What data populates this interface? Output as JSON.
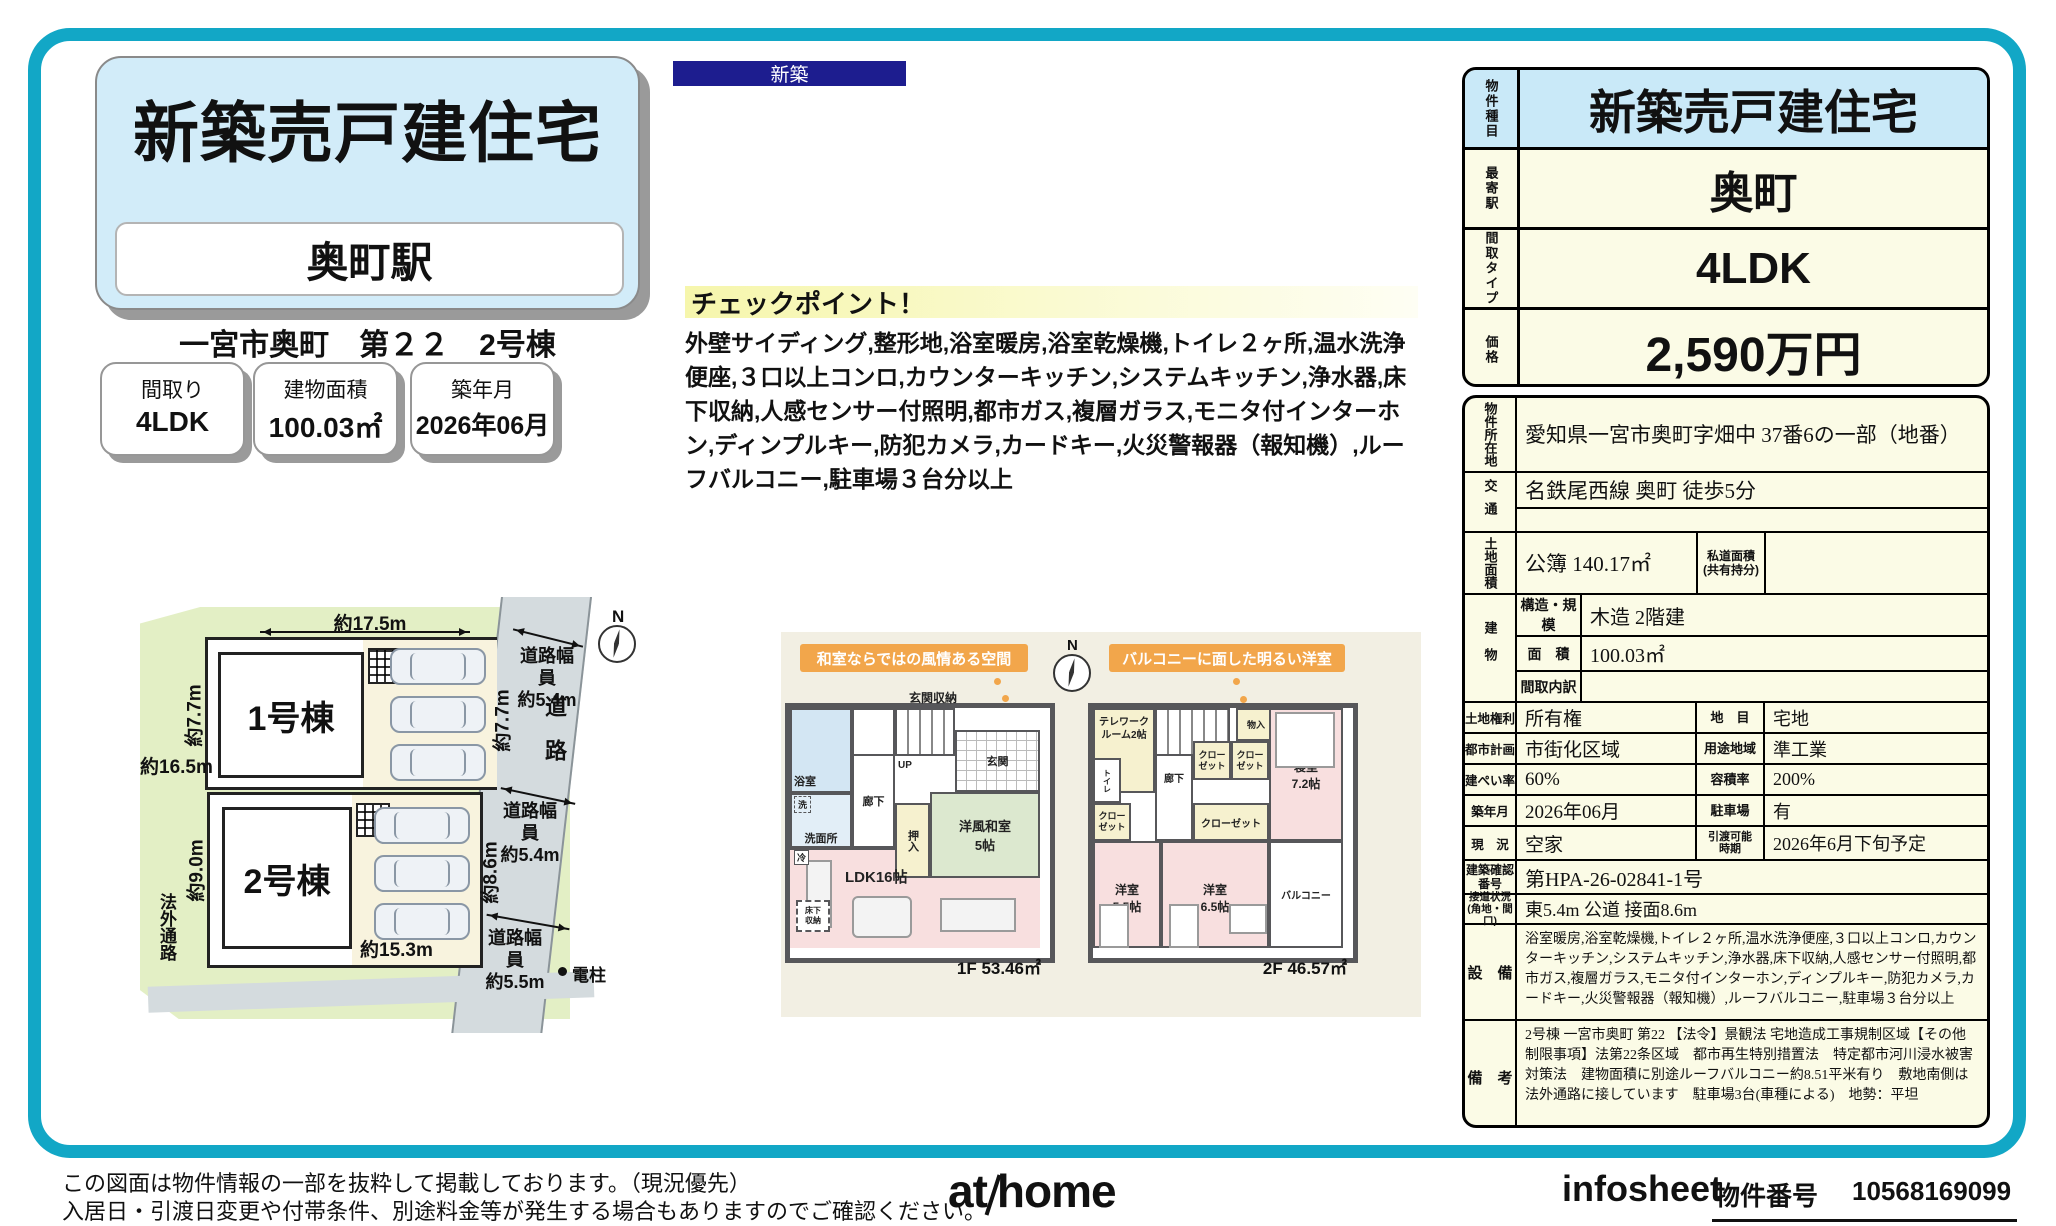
{
  "badge": {
    "label": "新築"
  },
  "header": {
    "title": "新築売戸建住宅",
    "station": "奥町駅",
    "subtitle": "一宮市奥町　第２２　2号棟"
  },
  "specs": [
    {
      "label": "間取り",
      "value": "4LDK"
    },
    {
      "label": "建物面積",
      "value": "100.03㎡"
    },
    {
      "label": "築年月",
      "value": "2026年06月"
    }
  ],
  "checkpoint": {
    "title": "チェックポイント！",
    "body": "外壁サイディング,整形地,浴室暖房,浴室乾燥機,トイレ２ヶ所,温水洗浄便座,３口以上コンロ,カウンターキッチン,システムキッチン,浄水器,床下収納,人感センサー付照明,都市ガス,複層ガラス,モニタ付インターホン,ディンプルキー,防犯カメラ,カードキー,火災警報器（報知機）,ルーフバルコニー,駐車場３台分以上"
  },
  "siteplan": {
    "north": "N",
    "lot1": "1号棟",
    "lot2": "2号棟",
    "dim_top": "約17.5m",
    "dim_left_upper": "約7.7m",
    "dim_left_mid": "約16.5m",
    "dim_left_lower": "約9.0m",
    "dim_bottom": "約15.3m",
    "dim_right_upper": "約7.7m",
    "dim_right_lower": "約8.6m",
    "road": "道路",
    "road_width_top": "道路幅員\n約5.4m",
    "road_width_mid": "道路幅員\n約5.4m",
    "road_width_bottom": "道路幅員\n約5.5m",
    "pole": "電柱",
    "outside_path": "法外通路"
  },
  "floorplan": {
    "callout1": "和室ならではの風情ある空間",
    "callout2": "バルコニーに面した明るい洋室",
    "north": "N",
    "f1": {
      "bath": "浴室",
      "laundry": "洗",
      "wash": "洗面所",
      "entrance_storage": "玄関収納",
      "up": "UP",
      "hall": "廊下",
      "entrance": "玄関",
      "oshiire": "押入",
      "tatami": "洋風和室\n5帖",
      "ldk": "LDK16帖",
      "underfloor": "床下\n収納",
      "fridge": "冷",
      "area": "1F 53.46㎡"
    },
    "f2": {
      "telework": "テレワーク\nルーム2帖",
      "dn": "DN",
      "mono": "物入",
      "closet_a": "クロー\nゼット",
      "closet_b": "クロー\nゼット",
      "hall": "廊下",
      "toilet": "トイレ",
      "bedroom": "寝室\n7.2帖",
      "closet_c": "クロー\nゼット",
      "closet_d": "クローゼット",
      "western_a": "洋室\n5.5帖",
      "western_b": "洋室\n6.5帖",
      "balcony": "バルコニー",
      "area": "2F 46.57㎡"
    }
  },
  "summary": {
    "rows": [
      {
        "label": "物件種目",
        "value": "新築売戸建住宅"
      },
      {
        "label": "最寄駅",
        "value": "奥町"
      },
      {
        "label": "間取タイプ",
        "value": "4LDK"
      },
      {
        "label": "価格",
        "value": "2,590万円"
      }
    ]
  },
  "details": {
    "location": {
      "label": "物件所在地",
      "value": "愛知県一宮市奥町字畑中 37番6の一部（地番）"
    },
    "access": {
      "label": "交通",
      "value": "名鉄尾西線 奥町 徒歩5分"
    },
    "land": {
      "label": "土地面積",
      "value": "公簿 140.17㎡",
      "sub_label": "私道面積\n(共有持分)",
      "sub_value": ""
    },
    "building": {
      "label": "建物",
      "rows": [
        {
          "label": "構造・規模",
          "value": "木造 2階建"
        },
        {
          "label": "面　積",
          "value": "100.03㎡"
        },
        {
          "label": "間取内訳",
          "value": ""
        }
      ]
    },
    "pairs": [
      {
        "l1": "土地権利",
        "v1": "所有権",
        "l2": "地　目",
        "v2": "宅地"
      },
      {
        "l1": "都市計画",
        "v1": "市街化区域",
        "l2": "用途地域",
        "v2": "準工業"
      },
      {
        "l1": "建ぺい率",
        "v1": "60%",
        "l2": "容積率",
        "v2": "200%"
      },
      {
        "l1": "築年月",
        "v1": "2026年06月",
        "l2": "駐車場",
        "v2": "有"
      },
      {
        "l1": "現　況",
        "v1": "空家",
        "l2": "引渡可能\n時期",
        "v2": "2026年6月下旬予定"
      }
    ],
    "confirm": {
      "label": "建築確認\n番号",
      "value": "第HPA-26-02841-1号"
    },
    "road": {
      "label": "接道状況\n(角地・間口)",
      "value": "東5.4m 公道 接面8.6m"
    },
    "equipment": {
      "label": "設　備",
      "value": "浴室暖房,浴室乾燥機,トイレ２ヶ所,温水洗浄便座,３口以上コンロ,カウンターキッチン,システムキッチン,浄水器,床下収納,人感センサー付照明,都市ガス,複層ガラス,モニタ付インターホン,ディンプルキー,防犯カメラ,カードキー,火災警報器（報知機）,ルーフバルコニー,駐車場３台分以上"
    },
    "remarks": {
      "label": "備　考",
      "value": "2号棟 一宮市奥町 第22 【法令】景観法 宅地造成工事規制区域【その他制限事項】法第22条区域　都市再生特別措置法　特定都市河川浸水被害対策法　建物面積に別途ルーフバルコニー約8.51平米有り　敷地南側は法外通路に接しています　駐車場3台(車種による)　地勢：平坦"
    }
  },
  "footer": {
    "disclaimer1": "この図面は物件情報の一部を抜粋して掲載しております。（現況優先）",
    "disclaimer2": "入居日・引渡日変更や付帯条件、別途料金等が発生する場合もありますのでご確認ください。",
    "logo_at": "at",
    "logo_home": "home",
    "sheet_name": "infosheet",
    "property_no_label": "物件番号",
    "property_no": "10568169099"
  }
}
